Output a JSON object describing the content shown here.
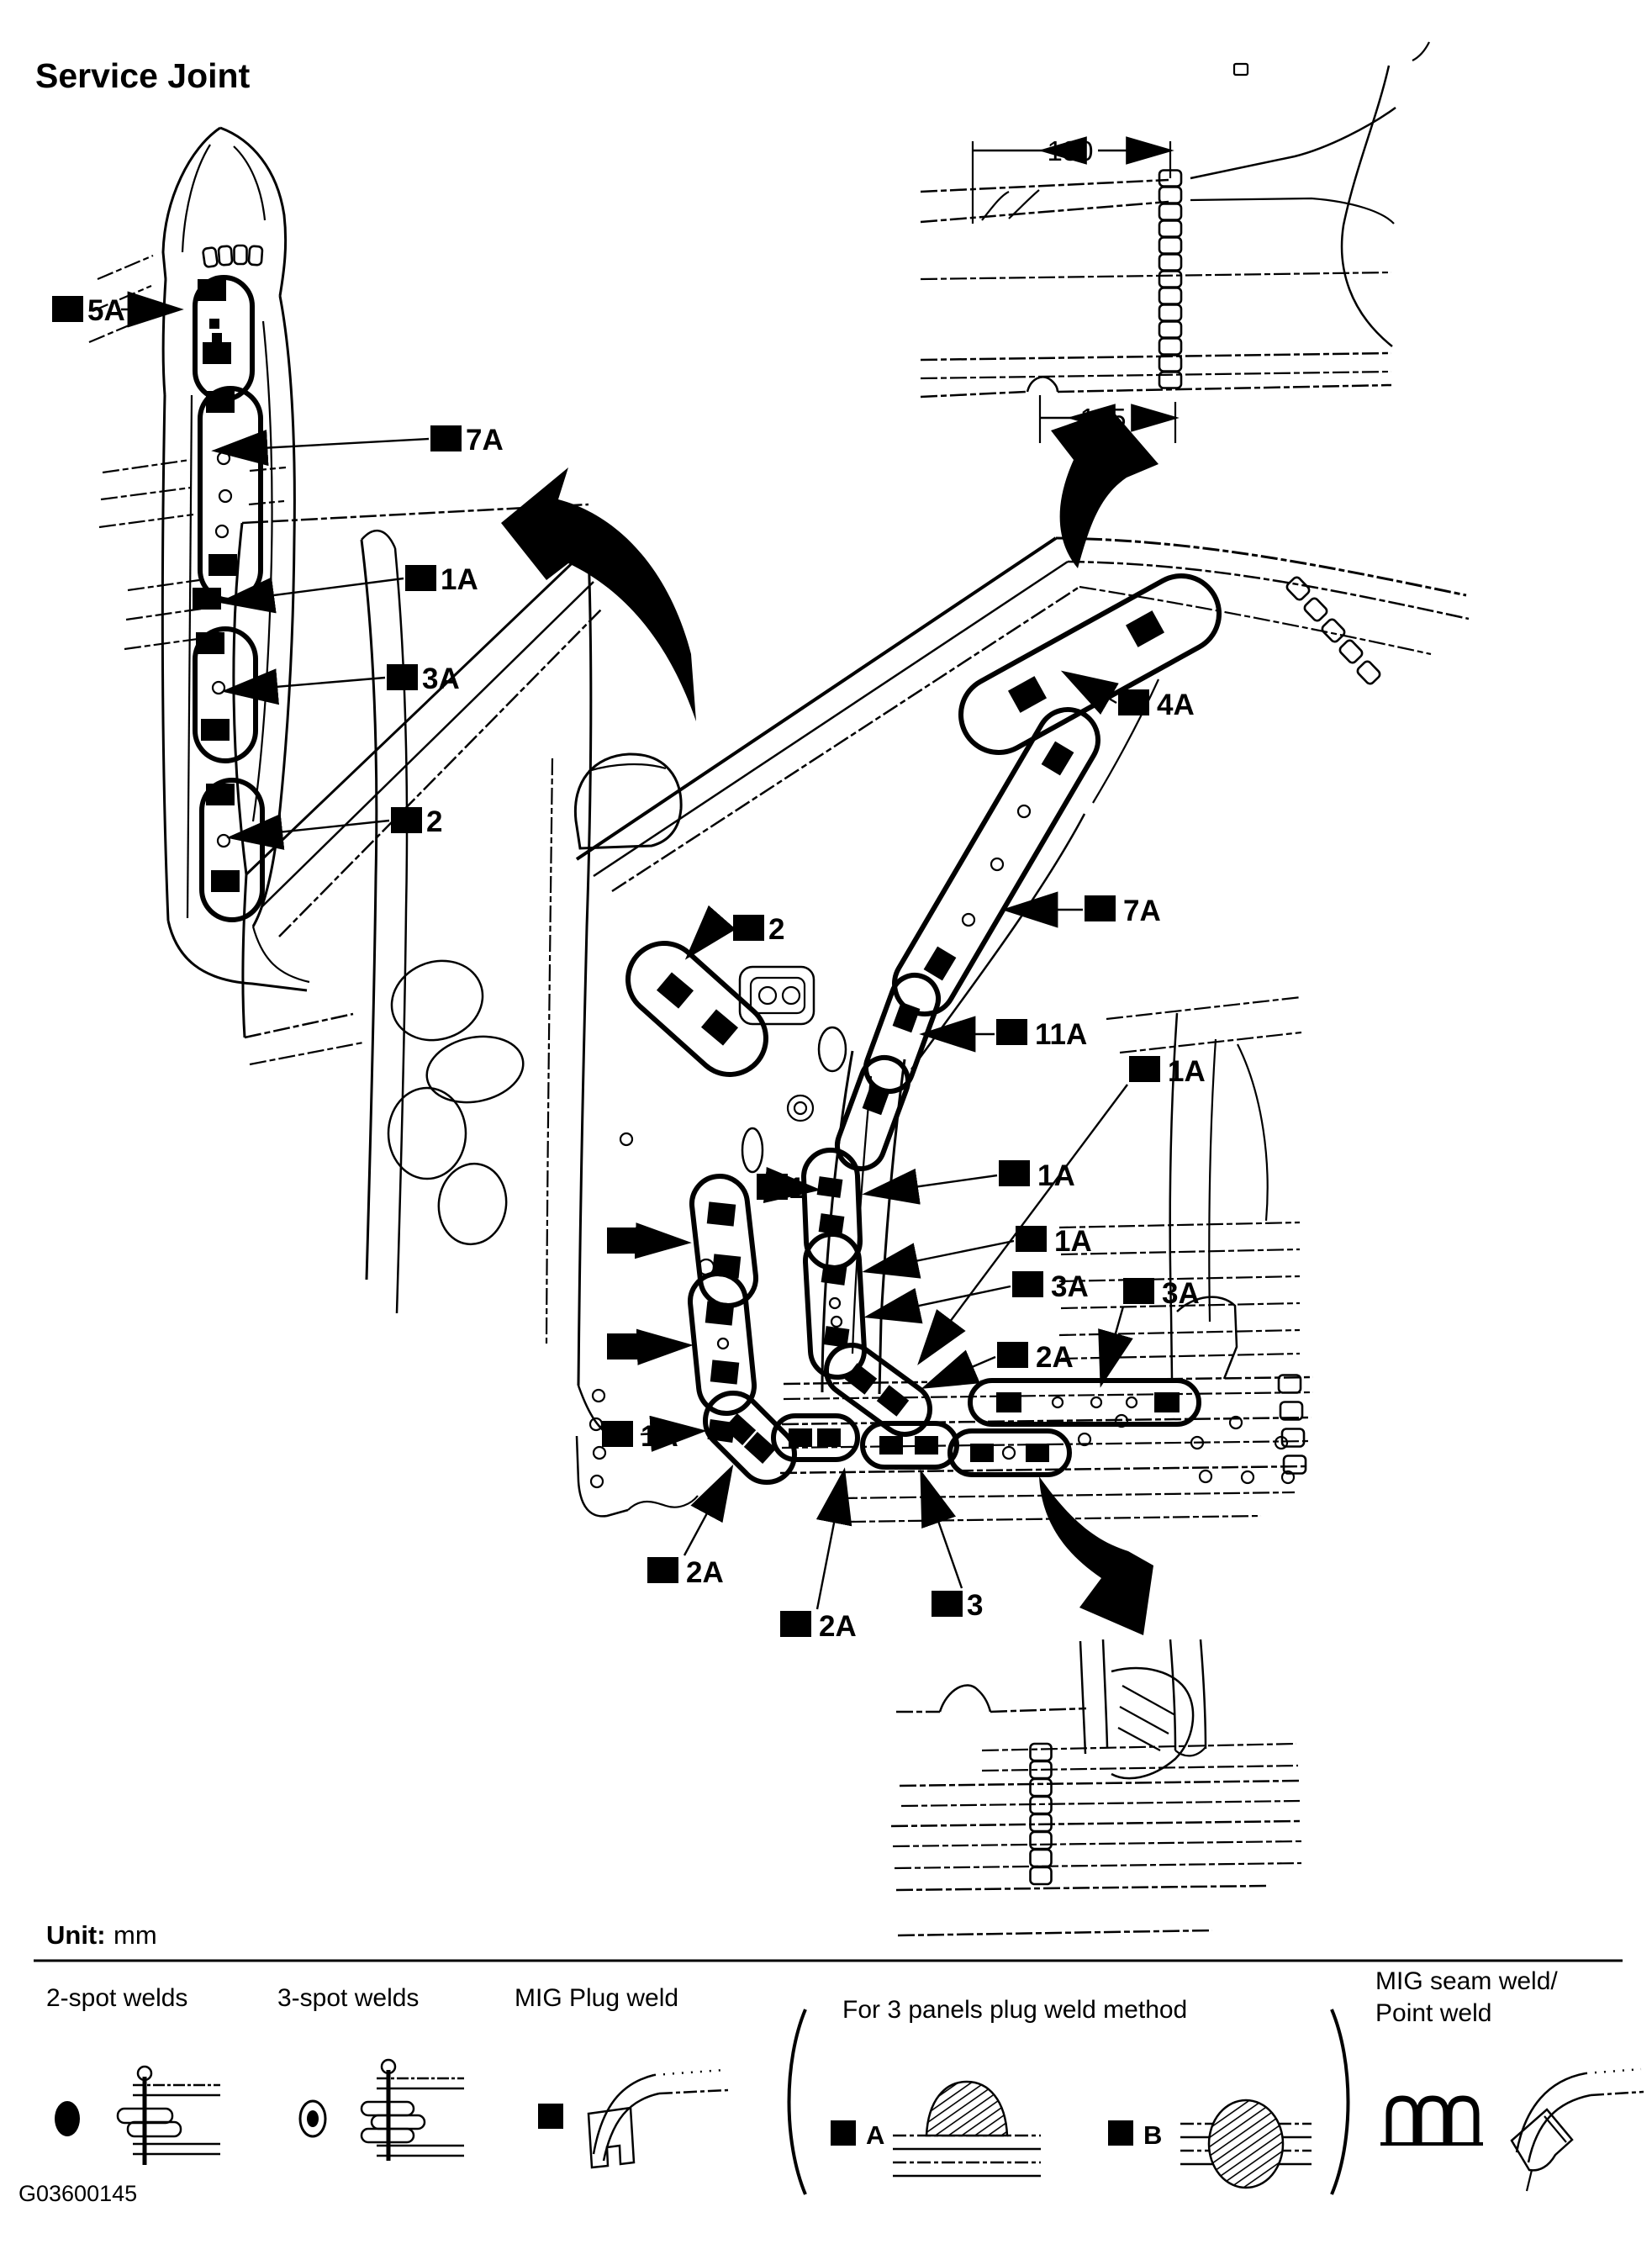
{
  "page": {
    "title": "Service Joint",
    "figure_id": "G03600145"
  },
  "unit": {
    "label": "Unit:",
    "value": "mm"
  },
  "detail_dimensions": {
    "d180": "180",
    "d125": "125"
  },
  "callouts": [
    {
      "id": "ld-5a",
      "label": "5A"
    },
    {
      "id": "ld-7a",
      "label": "7A"
    },
    {
      "id": "ld-1a",
      "label": "1A"
    },
    {
      "id": "ld-3a",
      "label": "3A"
    },
    {
      "id": "ld-2",
      "label": "2"
    },
    {
      "id": "m-2-cowl",
      "label": "2"
    },
    {
      "id": "m-4a",
      "label": "4A"
    },
    {
      "id": "m-7a",
      "label": "7A"
    },
    {
      "id": "m-11a",
      "label": "11A"
    },
    {
      "id": "m-1",
      "label": "1"
    },
    {
      "id": "m-1a-a",
      "label": "1A"
    },
    {
      "id": "m-1a-b",
      "label": "1A"
    },
    {
      "id": "m-3a-a",
      "label": "3A"
    },
    {
      "id": "m-2a-a",
      "label": "2A"
    },
    {
      "id": "m-2-b",
      "label": "2"
    },
    {
      "id": "m-2-c",
      "label": "2"
    },
    {
      "id": "m-1a-c",
      "label": "1A"
    },
    {
      "id": "m-1a-far",
      "label": "1A"
    },
    {
      "id": "m-3a-far",
      "label": "3A"
    },
    {
      "id": "m-2a-b",
      "label": "2A"
    },
    {
      "id": "m-2a-c",
      "label": "2A"
    },
    {
      "id": "m-3",
      "label": "3"
    }
  ],
  "legend": {
    "items": [
      {
        "id": "two-spot",
        "label": "2-spot welds"
      },
      {
        "id": "three-spot",
        "label": "3-spot welds"
      },
      {
        "id": "mig-plug",
        "label": "MIG Plug weld"
      },
      {
        "id": "three-panel",
        "label": "For 3 panels plug weld method",
        "options": [
          {
            "id": "A",
            "label": "A"
          },
          {
            "id": "B",
            "label": "B"
          }
        ]
      },
      {
        "id": "mig-seam",
        "label_line1": "MIG seam weld/",
        "label_line2": "Point weld"
      }
    ]
  }
}
